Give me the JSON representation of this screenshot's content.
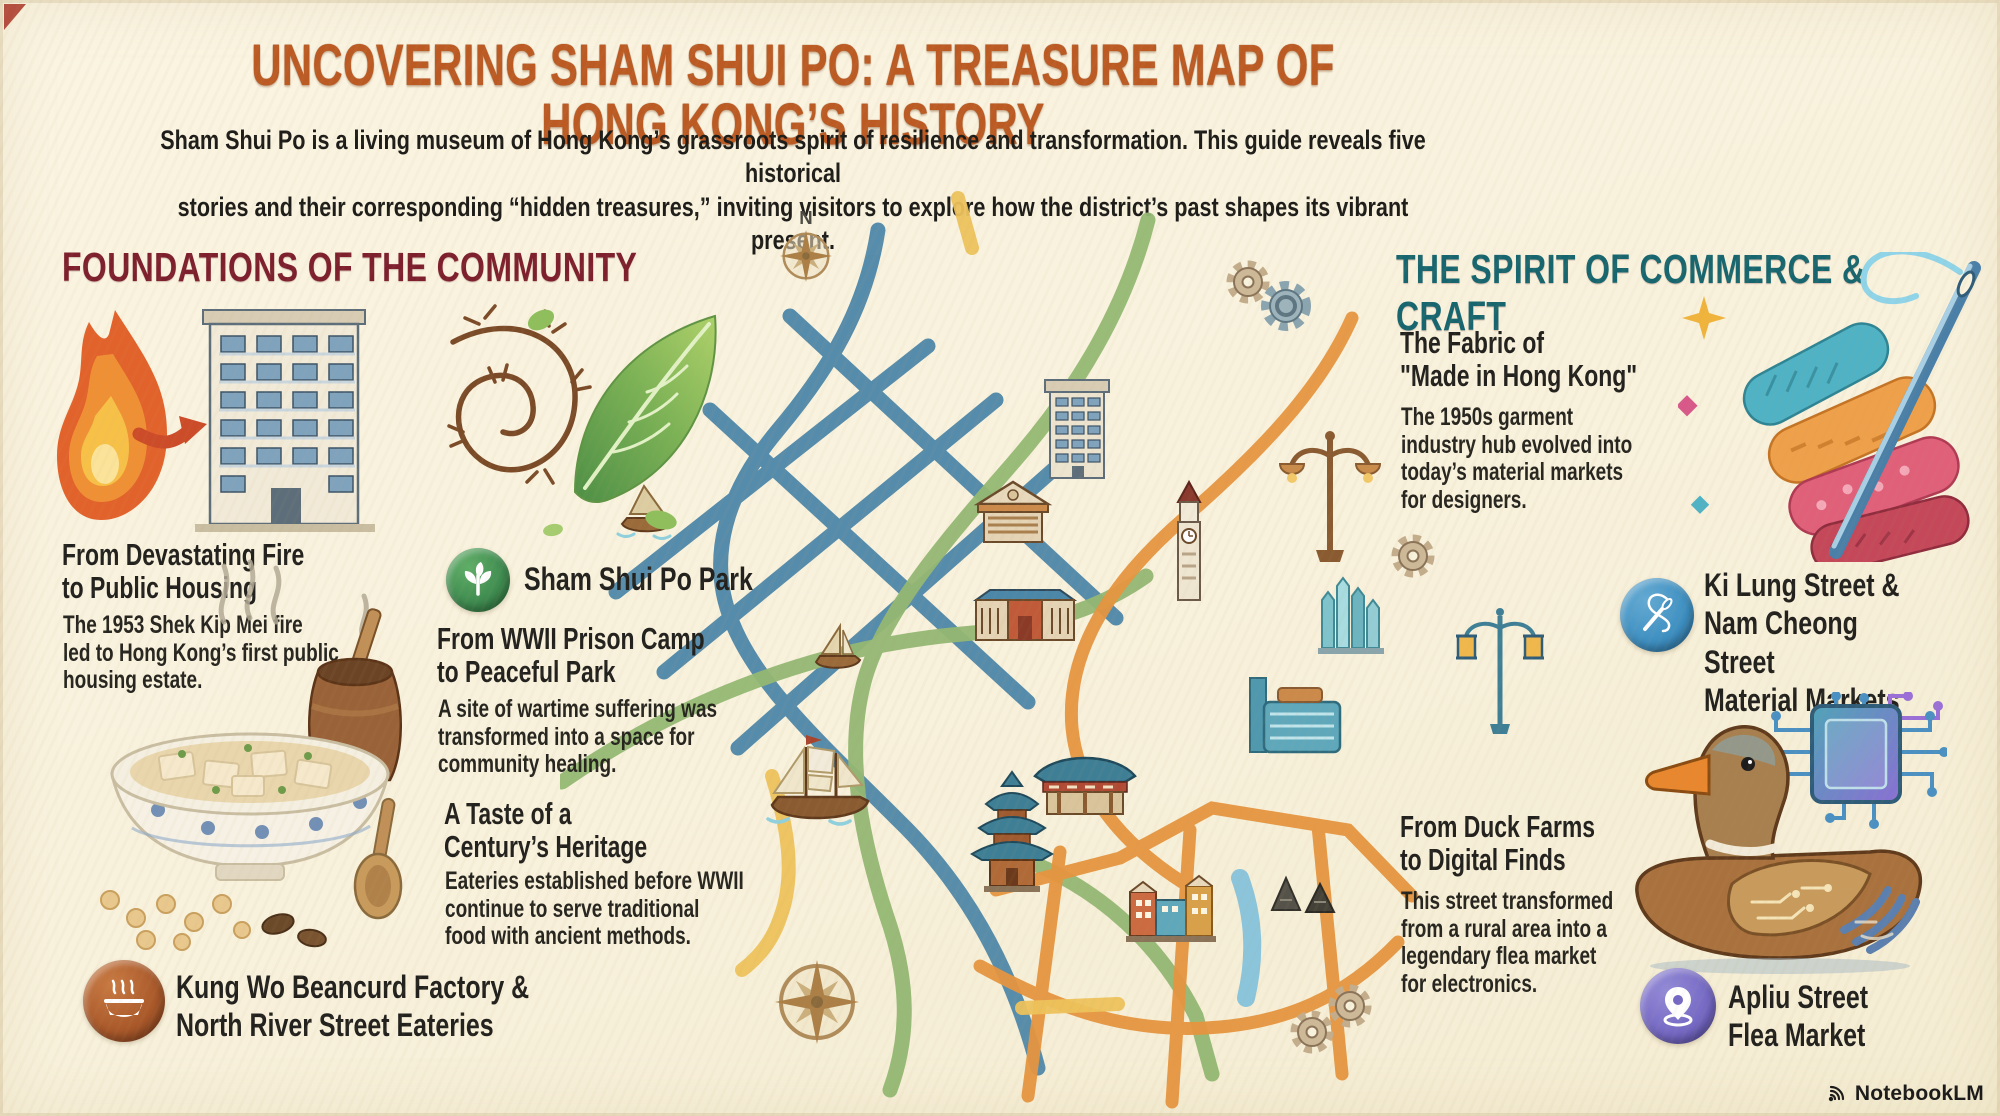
{
  "header": {
    "title": "UNCOVERING SHAM SHUI PO: A TREASURE MAP OF HONG KONG’S HISTORY",
    "subtitle": "Sham Shui Po is a living museum of Hong Kong’s grassroots spirit of resilience and transformation. This guide reveals five historical\nstories and their corresponding “hidden treasures,” inviting visitors to explore how the district’s past shapes its vibrant present."
  },
  "foundations": {
    "heading": "FOUNDATIONS OF THE COMMUNITY",
    "fire_block": {
      "title": "From Devastating Fire\nto Public Housing",
      "body": "The 1953 Shek Kip Mei fire\nled to Hong Kong’s first public\nhousing estate."
    },
    "park_badge": {
      "label": "Sham Shui Po Park",
      "icon": "plant-icon",
      "color": "#3e8b50"
    },
    "park_block": {
      "title": "From WWII Prison Camp\nto Peaceful Park",
      "body": "A site of wartime suffering was\ntransformed into a space for\ncommunity healing."
    },
    "taste_block": {
      "title": "A Taste of a\nCentury’s Heritage",
      "body": "Eateries established before WWII\ncontinue to serve traditional\nfood with ancient methods."
    },
    "eateries_badge": {
      "label": "Kung Wo Beancurd Factory &\nNorth River Street Eateries",
      "icon": "steaming-bowl-icon",
      "color": "#a9582a"
    }
  },
  "commerce": {
    "heading": "THE SPIRIT OF COMMERCE & CRAFT",
    "fabric_block": {
      "title": "The Fabric of\n\"Made in Hong Kong\"",
      "body": "The 1950s garment\nindustry hub evolved into\ntoday’s material markets\nfor designers."
    },
    "materials_badge": {
      "label": "Ki Lung Street &\nNam Cheong Street\nMaterial Markets",
      "icon": "needle-thread-icon",
      "color": "#3d8fc2"
    },
    "duck_block": {
      "title": "From Duck Farms\nto Digital Finds",
      "body": "This street transformed\nfrom a rural area into a\nlegendary flea market\nfor electronics."
    },
    "flea_badge": {
      "label": "Apliu Street\nFlea Market",
      "icon": "location-pin-icon",
      "color": "#7468c4"
    }
  },
  "map": {
    "compass_north_label": "N",
    "road_colors": {
      "teal": "#4e87a9",
      "green": "#94b873",
      "orange": "#e6953f",
      "yellow": "#edc25c",
      "river": "#7fc0dc"
    },
    "landmark_icons": [
      "compass-rose-icon",
      "tall-ship-icon",
      "junk-boat-icon",
      "sailboat-icon",
      "apartment-building-icon",
      "gate-building-icon",
      "market-hall-icon",
      "clock-tower-icon",
      "glass-towers-icon",
      "modern-building-icon",
      "pagoda-icon",
      "temple-icon",
      "shophouses-icon",
      "tents-icon",
      "gear-icon",
      "street-lamp-icon",
      "lantern-lamp-icon"
    ]
  },
  "colors": {
    "background": "#f8f1dc",
    "title": "#bc5a23",
    "foundations_heading": "#7d1f2d",
    "commerce_heading": "#17666f",
    "body_text": "#26251f",
    "badge_green": "#3e8b50",
    "badge_brown": "#a9582a",
    "badge_blue": "#3d8fc2",
    "badge_purple": "#7468c4"
  },
  "footer": {
    "brand": "NotebookLM"
  }
}
